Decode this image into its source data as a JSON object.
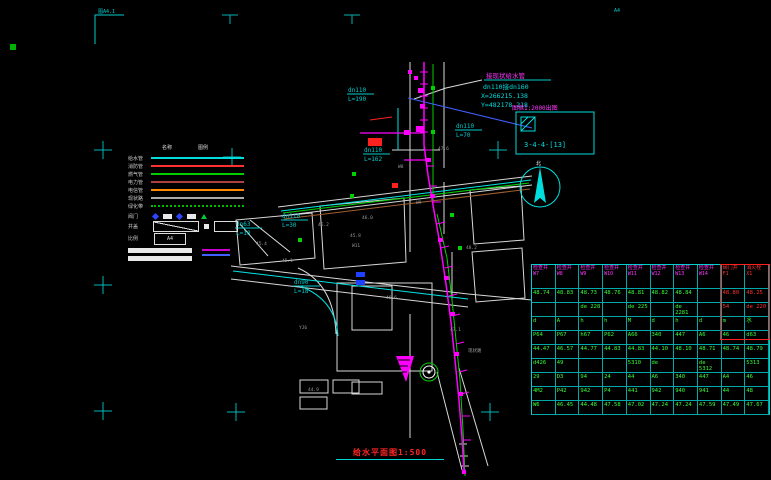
{
  "frame": {
    "corner_label": "图A4.1",
    "top_right_label": "A4"
  },
  "plan": {
    "connection_note": {
      "line1": "接现状给水管",
      "line2": "dn110接dn160",
      "line3": "X=266215.138",
      "line4": "Y=482178.218"
    },
    "detail_note": {
      "scale_text": "图框1:2000出图",
      "sheet_code": "3-4-4-[13]"
    },
    "north_label": "北",
    "pipe_labels": [
      {
        "d": "dn110",
        "len": "L=190",
        "x": 348,
        "y": 92
      },
      {
        "d": "dn110",
        "len": "L=70",
        "x": 456,
        "y": 128
      },
      {
        "d": "dn110",
        "len": "L=30",
        "x": 282,
        "y": 218
      },
      {
        "d": "dn63",
        "len": "L=10",
        "x": 236,
        "y": 226
      },
      {
        "d": "dn110",
        "len": "L=162",
        "x": 364,
        "y": 152
      },
      {
        "d": "dn90",
        "len": "L=18",
        "x": 294,
        "y": 284
      }
    ],
    "annotations": [
      {
        "t": "46.2",
        "x": 318,
        "y": 226
      },
      {
        "t": "45.8",
        "x": 350,
        "y": 237
      },
      {
        "t": "W9",
        "x": 416,
        "y": 204
      },
      {
        "t": "46.6",
        "x": 386,
        "y": 299
      },
      {
        "t": "47.1",
        "x": 450,
        "y": 331
      },
      {
        "t": "YJ6",
        "x": 299,
        "y": 329
      },
      {
        "t": "48.2",
        "x": 466,
        "y": 249
      },
      {
        "t": "45.4",
        "x": 256,
        "y": 245
      },
      {
        "t": "现状路",
        "x": 468,
        "y": 352
      },
      {
        "t": "44.9",
        "x": 308,
        "y": 391
      },
      {
        "t": "46.0",
        "x": 362,
        "y": 219
      },
      {
        "t": "W11",
        "x": 352,
        "y": 247
      },
      {
        "t": "45.1",
        "x": 282,
        "y": 262
      },
      {
        "t": "47.6",
        "x": 438,
        "y": 150
      },
      {
        "t": "W8",
        "x": 398,
        "y": 168
      }
    ]
  },
  "legend": {
    "col1": "名称",
    "col2": "图例",
    "items": [
      {
        "label": "给水管",
        "color": "#00dddd",
        "dash": "solid"
      },
      {
        "label": "消防管",
        "color": "#ff3030",
        "dash": "solid"
      },
      {
        "label": "燃气管",
        "color": "#00cc00",
        "dash": "solid"
      },
      {
        "label": "电力管",
        "color": "#aa4040",
        "dash": "solid"
      },
      {
        "label": "电信管",
        "color": "#ff8800",
        "dash": "solid"
      },
      {
        "label": "现状路",
        "color": "#aaaaaa",
        "dash": "solid"
      },
      {
        "label": "绿化带",
        "color": "#00bb00",
        "dash": "dotted"
      }
    ],
    "markers_label": "阀门",
    "cover_label": "井盖",
    "scale_label": "比例",
    "sheet_label": "A4"
  },
  "table": {
    "columns": [
      {
        "t": "检查井",
        "c": "W7",
        "red": false
      },
      {
        "t": "检查井",
        "c": "W8",
        "red": false
      },
      {
        "t": "检查井",
        "c": "W9",
        "red": false
      },
      {
        "t": "检查井",
        "c": "W10",
        "red": false
      },
      {
        "t": "检查井",
        "c": "W11",
        "red": false
      },
      {
        "t": "检查井",
        "c": "W12",
        "red": false
      },
      {
        "t": "检查井",
        "c": "W13",
        "red": false
      },
      {
        "t": "检查井",
        "c": "W14",
        "red": false
      },
      {
        "t": "阀门井",
        "c": "F1",
        "red": true
      },
      {
        "t": "消火栓",
        "c": "X1",
        "red": true
      }
    ],
    "rows": [
      [
        "48.74",
        "48.83",
        "48.73",
        "48.76",
        "48.81",
        "48.82",
        "48.84",
        "",
        "48.80",
        "48.25"
      ],
      [
        "",
        "",
        "de 228",
        "",
        "de 225",
        "",
        "de 2281",
        "",
        "54",
        "de 220"
      ],
      [
        "d",
        "A",
        "h",
        "h",
        "M",
        "d",
        "h",
        "d",
        "m",
        "水"
      ],
      [
        "P64",
        "P67",
        "h67",
        "P62",
        "A66",
        "340",
        "447",
        "A6",
        "46",
        "d63"
      ],
      [
        "44.47",
        "46.57",
        "44.77",
        "44.83",
        "44.83",
        "44.10",
        "48.10",
        "48.71",
        "48.74",
        "48.79"
      ],
      [
        "d426",
        "49",
        "",
        "",
        "5310",
        "de",
        "",
        "de 5312",
        "",
        "5313"
      ],
      [
        "29",
        "D3",
        "94",
        "24",
        "44",
        "A6",
        "340",
        "447",
        "A4",
        "46"
      ],
      [
        "4M2",
        "P42",
        "942",
        "P4",
        "441",
        "942",
        "940",
        "941",
        "44",
        "48"
      ],
      [
        "W6",
        "46.45",
        "44.48",
        "47.58",
        "47.02",
        "47.24",
        "47.24",
        "47.59",
        "47.49",
        "47.67"
      ]
    ]
  },
  "title": {
    "text": "给水平面图1:500"
  },
  "colors": {
    "pipe_main": "#ff00ff",
    "utility_cyan": "#00e5e5",
    "utility_green": "#00d000",
    "parcel_white": "#d8d8d8",
    "highlight_red": "#ff2020",
    "table_border": "#00cfcf",
    "title_red": "#ff2525"
  }
}
